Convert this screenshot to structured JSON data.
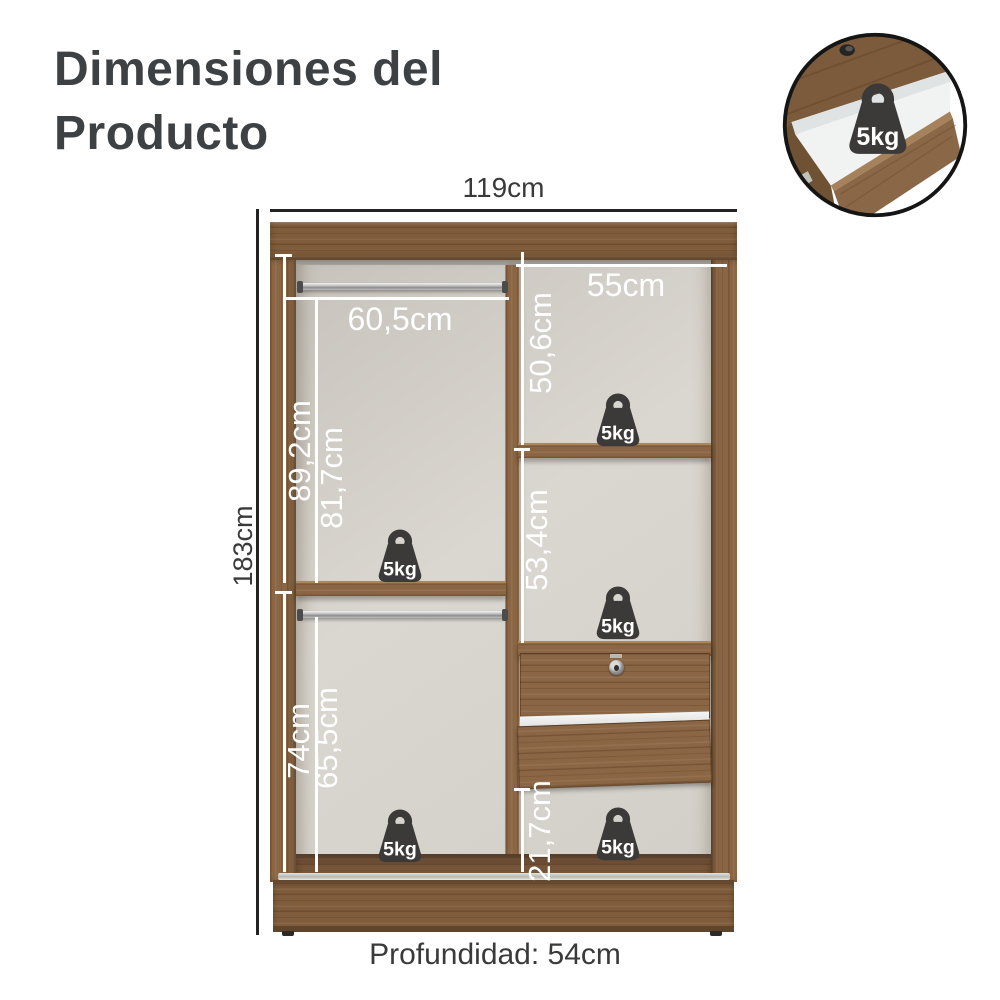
{
  "title": "Dimensiones del Producto",
  "inset": {
    "weight_label": "5kg"
  },
  "wardrobe": {
    "width_label": "119cm",
    "height_label": "183cm",
    "depth_label": "Profundidad: 54cm",
    "left_section": {
      "rod_width_label": "60,5cm",
      "upper_height_label": "89,2cm",
      "upper_inner_height_label": "81,7cm",
      "lower_height_label": "74cm",
      "lower_inner_height_label": "65,5cm",
      "upper_weight_label": "5kg",
      "lower_weight_label": "5kg"
    },
    "right_section": {
      "width_label": "55cm",
      "upper_height_label": "50,6cm",
      "middle_height_label": "53,4cm",
      "lower_height_label": "21,7cm",
      "upper_weight_label": "5kg",
      "middle_weight_label": "5kg",
      "lower_weight_label": "5kg"
    }
  },
  "colors": {
    "wood": "#8a6644",
    "wood_dark": "#77563a",
    "interior": "#d7d4cd",
    "weight_icon": "#3b3a39",
    "dimension_line_light": "#ffffff",
    "dimension_line_dark": "#232323",
    "text_dark": "#3d4043"
  }
}
